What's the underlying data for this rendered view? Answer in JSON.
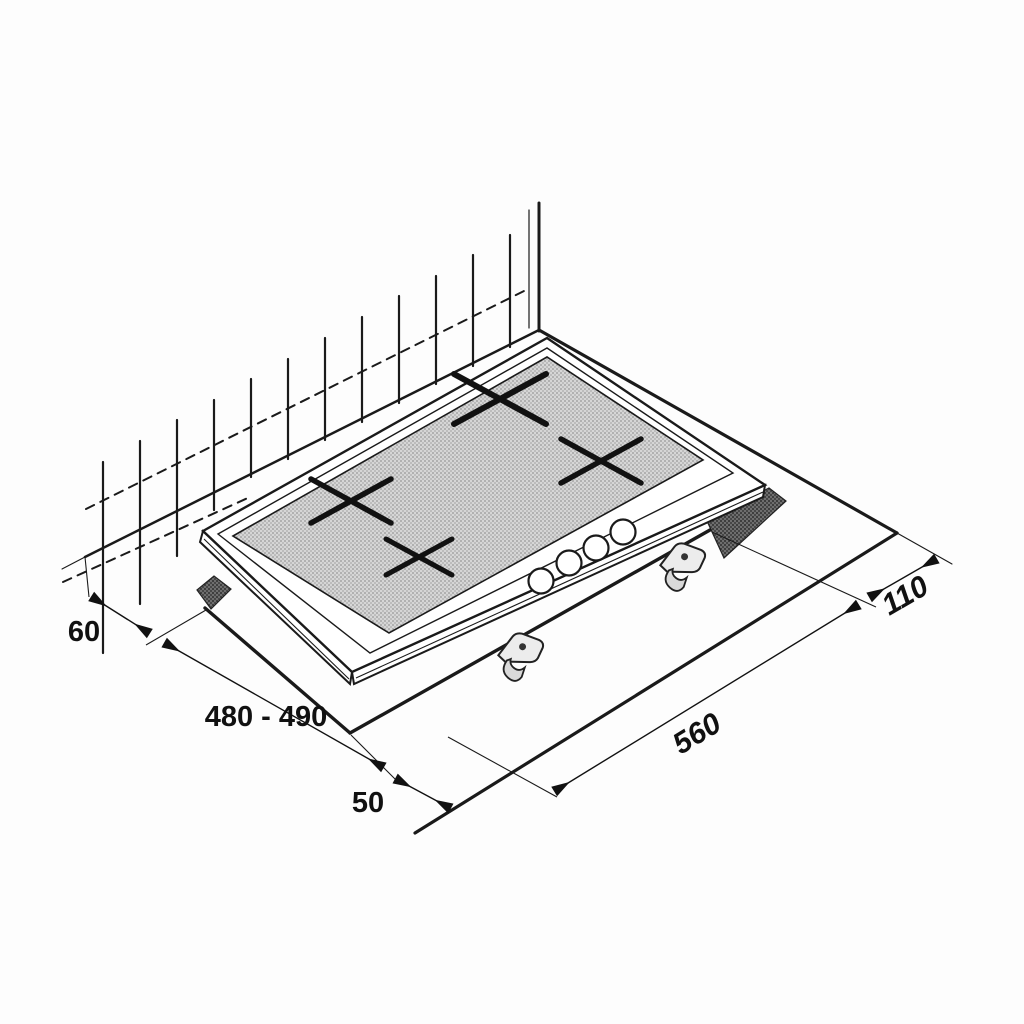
{
  "diagram": {
    "type": "installation-dimension-drawing",
    "labels": {
      "wall_clearance": "60",
      "cutout_depth": "480 - 490",
      "front_clearance": "50",
      "cutout_width": "560",
      "right_clearance": "110"
    },
    "colors": {
      "ink": "#1a1a1a",
      "cutout_band": "#5e5e5e",
      "glass_halftone": "#d6d6d6"
    },
    "icons": [
      "wall-tile-lines",
      "burner-cross-icon",
      "control-knob",
      "fixing-clamp-icon",
      "dimension-arrow"
    ]
  }
}
